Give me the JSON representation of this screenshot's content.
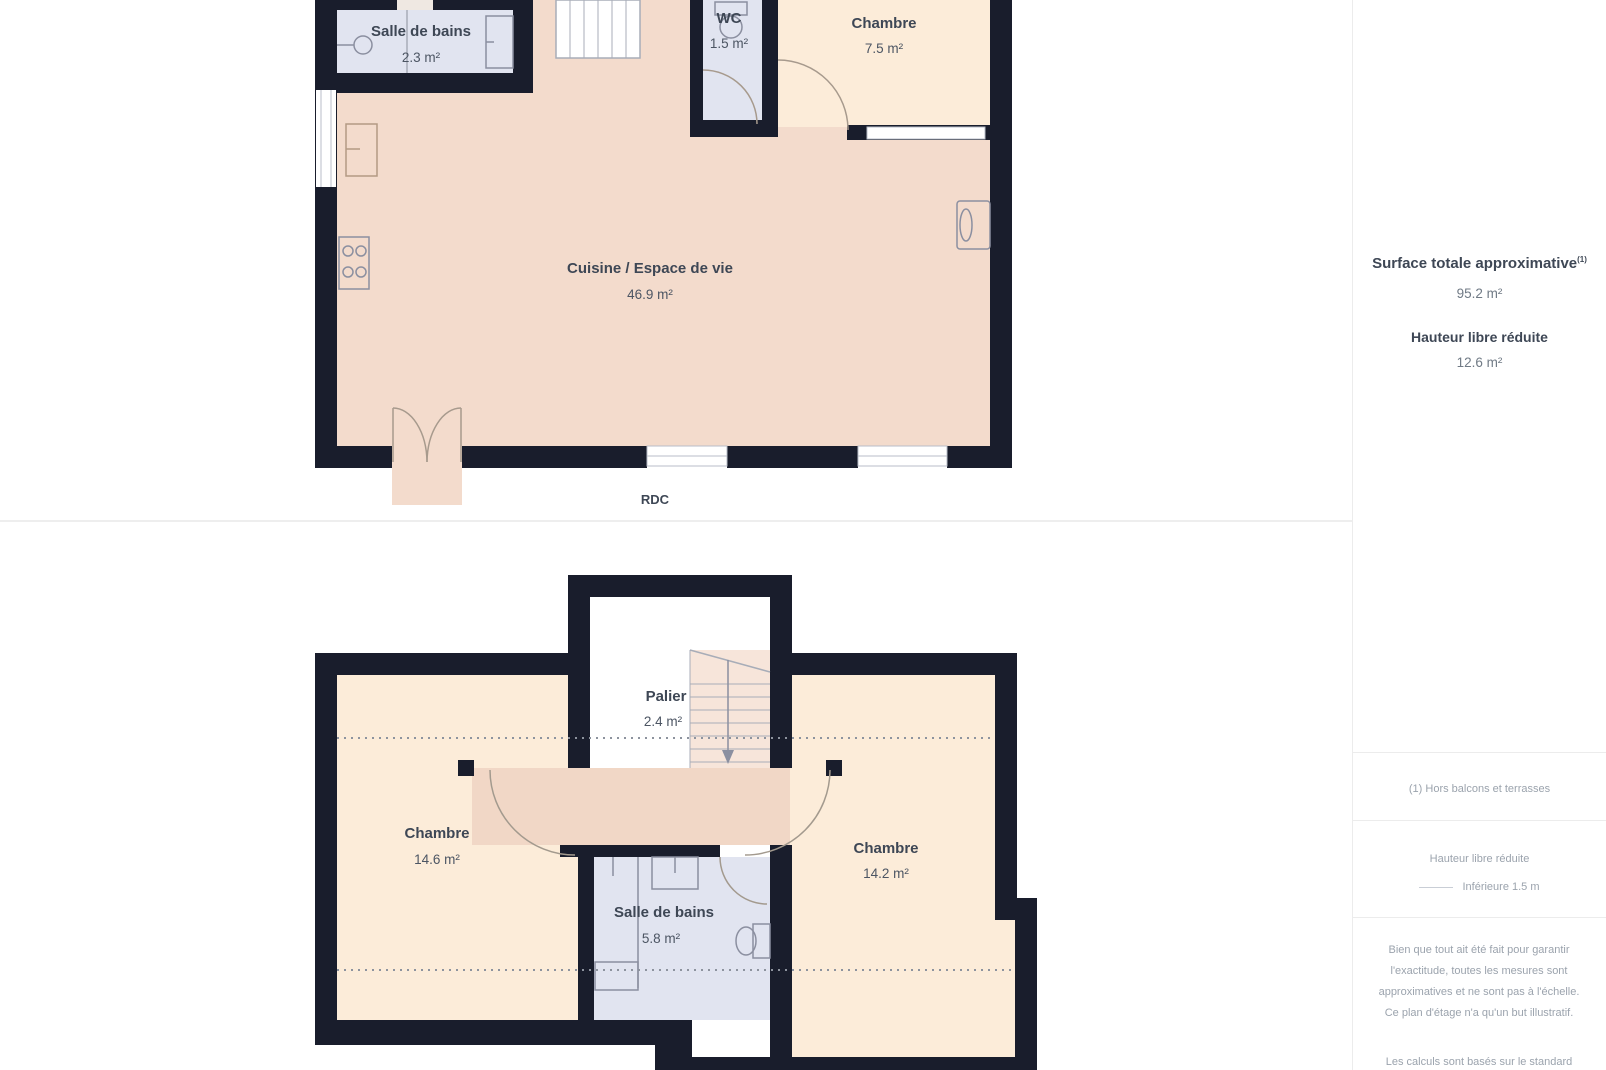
{
  "page": {
    "background": "#ffffff"
  },
  "colors": {
    "wall": "#191d2c",
    "floor_pink": "#f3dbcc",
    "floor_cream": "#fcecd9",
    "floor_gray": "#e1e4f0",
    "floor_landing": "#f1d7c6",
    "label_dark": "#3e4755",
    "muted_text": "#9ba3ad",
    "fixture_stroke": "#8b8fa0",
    "door_stroke": "#a79a8d"
  },
  "floors": {
    "rdc": {
      "label": "RDC",
      "rooms": {
        "salle_de_bains": {
          "name": "Salle de bains",
          "area": "2.3 m²"
        },
        "wc": {
          "name": "WC",
          "area": "1.5 m²"
        },
        "chambre": {
          "name": "Chambre",
          "area": "7.5 m²"
        },
        "cuisine": {
          "name": "Cuisine / Espace de vie",
          "area": "46.9 m²"
        }
      }
    },
    "etage": {
      "rooms": {
        "palier": {
          "name": "Palier",
          "area": "2.4 m²"
        },
        "chambre_gauche": {
          "name": "Chambre",
          "area": "14.6 m²"
        },
        "chambre_droite": {
          "name": "Chambre",
          "area": "14.2 m²"
        },
        "salle_de_bains": {
          "name": "Salle de bains",
          "area": "5.8 m²"
        }
      }
    }
  },
  "sidebar": {
    "surface_title": "Surface totale approximative",
    "surface_title_sup": "(1)",
    "surface_value": "95.2 m²",
    "reduced_height_title": "Hauteur libre réduite",
    "reduced_height_value": "12.6 m²",
    "footnote": "(1) Hors balcons et terrasses",
    "legend_title": "Hauteur libre réduite",
    "legend_value": "Inférieure 1.5 m",
    "disclaimer_1": "Bien que tout ait été fait pour garantir l'exactitude, toutes les mesures sont approximatives et ne sont pas à l'échelle. Ce plan d'étage n'a qu'un but illustratif.",
    "disclaimer_2": "Les calculs sont basés sur le standard"
  }
}
